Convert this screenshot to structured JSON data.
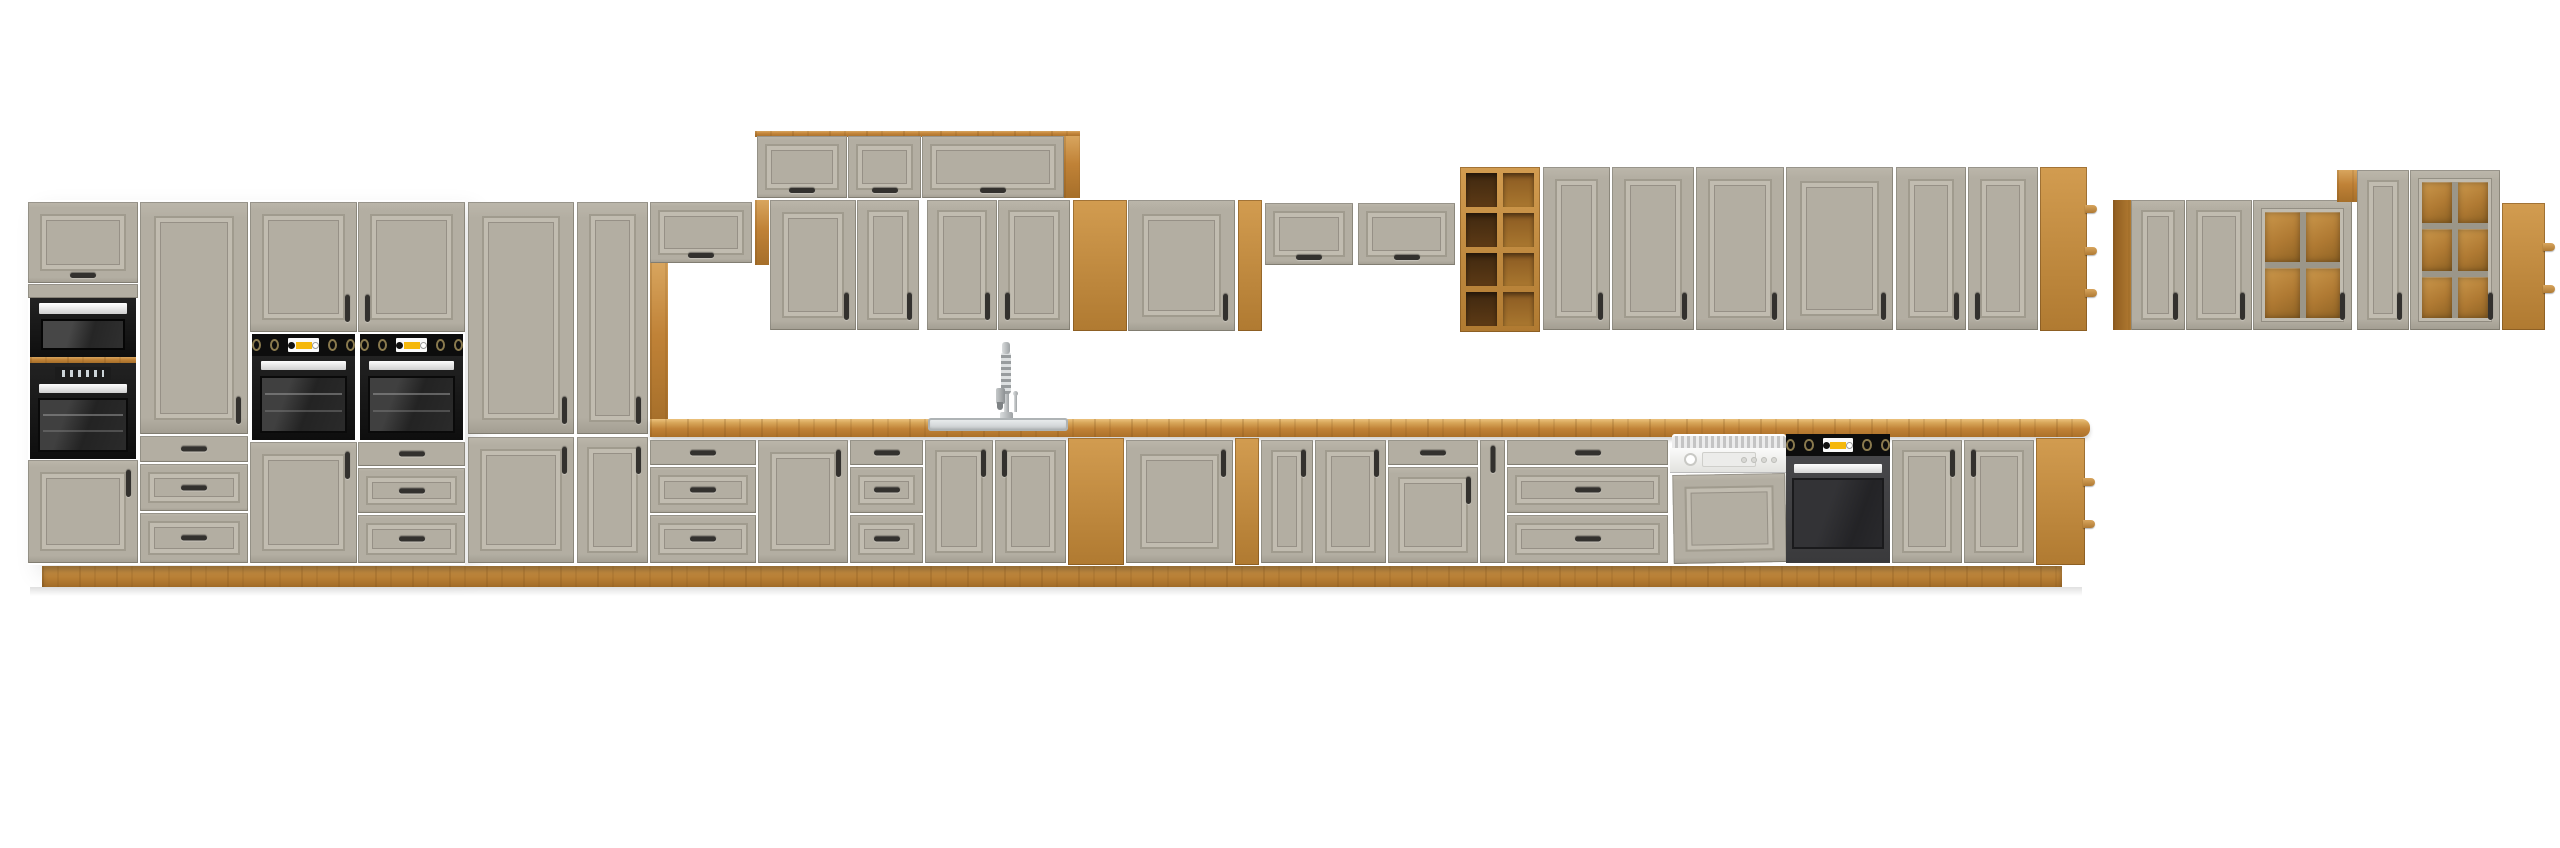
{
  "scene": {
    "type": "product-render",
    "subject": "Modular kitchen cabinet set, clay-grey framed fronts with artisan oak countertop, plinth and open shelving, built-in black appliances",
    "background": "#ffffff",
    "visible_text": ""
  },
  "palette": {
    "bg": "#ffffff",
    "grey": "#b3aea2",
    "grey-hi": "#c1bcb0",
    "grey-lo": "#9a9588",
    "oak": "#c08237",
    "oak-light": "#d8a55e",
    "oak-dark": "#8f5c20",
    "handle": "#33312e",
    "yellow": "#f5b80c",
    "black": "#141414",
    "steel": "#c9cdcf"
  },
  "appliance_counts": {
    "microwave": 1,
    "built_in_ovens_tall": 3,
    "built_in_oven_base": 1,
    "dishwasher": 1,
    "sink": 1,
    "faucet": 1
  },
  "inventory": [
    {
      "id": "tall-flap-cabinet",
      "label": "Tall unit flap door"
    },
    {
      "id": "built-in-microwave",
      "label": "Built-in microwave"
    },
    {
      "id": "built-in-oven-upper-left",
      "label": "Built-in oven (tall unit 1)"
    },
    {
      "id": "tall-unit-lower-door-1",
      "label": "Tall unit lower door"
    },
    {
      "id": "tall-door-3-drawer-unit",
      "label": "Tall unit with door and 3 drawers"
    },
    {
      "id": "oven-housing-column-1",
      "label": "Oven housing column with knob panel and lower door"
    },
    {
      "id": "oven-housing-column-2",
      "label": "Oven housing column with knob panel and 3 drawers"
    },
    {
      "id": "pantry-wide",
      "label": "Tall pantry cabinet, wide, 2 doors"
    },
    {
      "id": "pantry-narrow",
      "label": "Tall pantry cabinet, narrow, 2 doors"
    },
    {
      "id": "wall-flap-cabinet-1",
      "label": "Wall flap cabinet over counter end"
    },
    {
      "id": "oak-pillar",
      "label": "Oak side panel strip"
    },
    {
      "id": "wall-top-flap-row",
      "label": "Top row of 3 flap wall cabinets with oak side"
    },
    {
      "id": "wall-doors-over-sink",
      "label": "4 wall cabinet doors over sink"
    },
    {
      "id": "wall-open-shelf-3",
      "label": "Oak open wall shelf, 3 compartments"
    },
    {
      "id": "wall-door-wide",
      "label": "Wide wall cabinet door"
    },
    {
      "id": "wall-open-shelf-column",
      "label": "Narrow oak open shelf column, 5 compartments"
    },
    {
      "id": "wall-flap-cabinet-2",
      "label": "Wall flap cabinet"
    },
    {
      "id": "wall-flap-cabinet-3",
      "label": "Wall flap cabinet"
    },
    {
      "id": "oak-cube-shelf",
      "label": "Oak cube shelf 2x4"
    },
    {
      "id": "wall-row-doors",
      "label": "Long wall cabinet row, 6 doors"
    },
    {
      "id": "wall-end-shelf",
      "label": "Oak open end shelf, wall row"
    },
    {
      "id": "right-wall-door-1",
      "label": "Right group wall door"
    },
    {
      "id": "right-wall-door-2",
      "label": "Right group wall door"
    },
    {
      "id": "glass-cabinet-2x2",
      "label": "Glass-front wall cabinet 2x2"
    },
    {
      "id": "tall-wall-door",
      "label": "Taller right group wall door"
    },
    {
      "id": "glass-cabinet-2x3",
      "label": "Glass-front wall cabinet 2x3"
    },
    {
      "id": "right-end-shelf",
      "label": "Oak open end shelf, right group"
    },
    {
      "id": "base-drawer-unit-1",
      "label": "Base 3-drawer unit"
    },
    {
      "id": "base-door-1",
      "label": "Base door cabinet"
    },
    {
      "id": "base-drawer-unit-2",
      "label": "Base 3-drawer unit"
    },
    {
      "id": "sink-cabinet",
      "label": "Sink base cabinet, 2 doors"
    },
    {
      "id": "sink",
      "label": "Inset stainless sink"
    },
    {
      "id": "faucet",
      "label": "Spring spout kitchen faucet"
    },
    {
      "id": "base-open-shelf",
      "label": "Oak open base shelf"
    },
    {
      "id": "base-door-wide",
      "label": "Wide base door cabinet"
    },
    {
      "id": "base-shelf-column",
      "label": "Narrow oak base shelf column"
    },
    {
      "id": "base-door-2",
      "label": "Base door cabinet"
    },
    {
      "id": "base-door-3",
      "label": "Base door cabinet"
    },
    {
      "id": "base-drawer-door-unit",
      "label": "Base cabinet, drawer over door"
    },
    {
      "id": "base-filler-door",
      "label": "Narrow base filler door"
    },
    {
      "id": "base-drawer-unit-3",
      "label": "Wide base 3-drawer unit"
    },
    {
      "id": "dishwasher",
      "label": "Semi-integrated dishwasher with furniture panel"
    },
    {
      "id": "built-in-oven-base",
      "label": "Under-counter built-in oven with knob panel"
    },
    {
      "id": "base-door-4",
      "label": "Base door cabinet"
    },
    {
      "id": "base-door-5",
      "label": "Base door cabinet"
    },
    {
      "id": "base-end-shelf",
      "label": "Oak open base end shelf"
    },
    {
      "id": "countertop",
      "label": "Oak countertop"
    },
    {
      "id": "plinth",
      "label": "Oak plinth"
    }
  ]
}
